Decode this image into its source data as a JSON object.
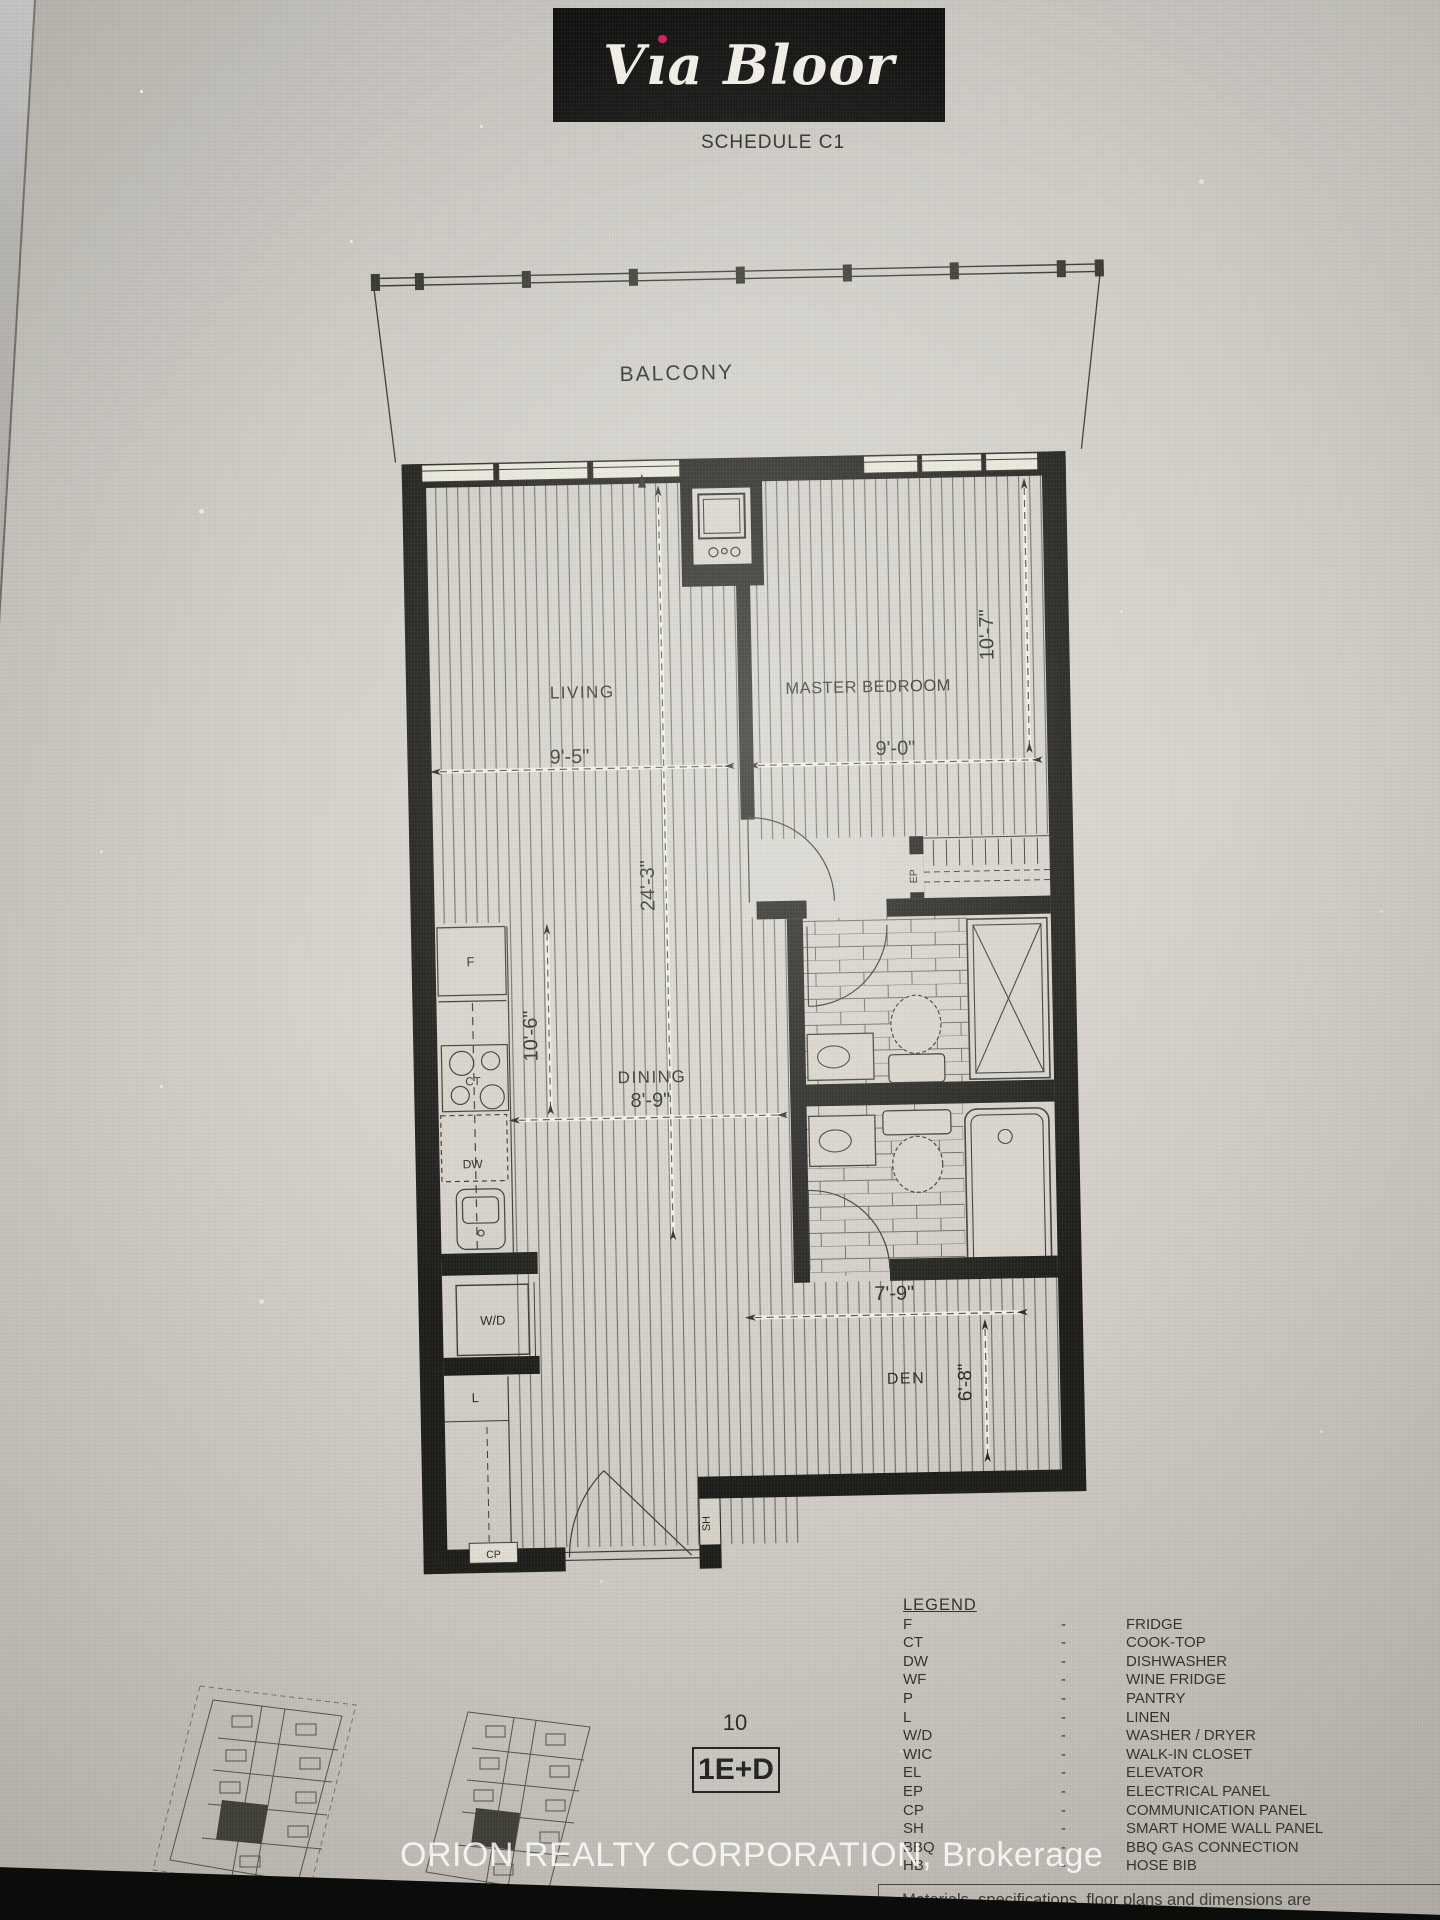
{
  "page": {
    "schedule_label": "SCHEDULE C1"
  },
  "brand": {
    "name_v": "V",
    "name_i": "ı",
    "name_rest": "a Bloor"
  },
  "plan": {
    "rooms": {
      "balcony": "BALCONY",
      "living": "LIVING",
      "master_bedroom": "MASTER BEDROOM",
      "dining": "DINING",
      "den": "DEN"
    },
    "dims": {
      "living_width": "9'-5\"",
      "master_width": "9'-0\"",
      "master_depth": "10'-7\"",
      "overall_depth": "24'-3\"",
      "kitchen_depth": "10'-6\"",
      "dining_width": "8'-9\"",
      "den_width": "7'-9\"",
      "den_depth": "6'-8\""
    },
    "fixtures": {
      "fridge": "F",
      "cooktop": "CT",
      "dishwasher": "DW",
      "washer_dryer": "W/D",
      "linen": "L",
      "electrical_panel": "EP",
      "communication_panel": "CP",
      "smart_home": "SH"
    }
  },
  "unit": {
    "level": "10",
    "model": "1E+D"
  },
  "legend": {
    "title": "LEGEND",
    "separator": "-",
    "rows": [
      {
        "abbr": "F",
        "desc": "FRIDGE"
      },
      {
        "abbr": "CT",
        "desc": "COOK-TOP"
      },
      {
        "abbr": "DW",
        "desc": "DISHWASHER"
      },
      {
        "abbr": "WF",
        "desc": "WINE FRIDGE"
      },
      {
        "abbr": "P",
        "desc": "PANTRY"
      },
      {
        "abbr": "L",
        "desc": "LINEN"
      },
      {
        "abbr": "W/D",
        "desc": "WASHER / DRYER"
      },
      {
        "abbr": "WIC",
        "desc": "WALK-IN CLOSET"
      },
      {
        "abbr": "EL",
        "desc": "ELEVATOR"
      },
      {
        "abbr": "EP",
        "desc": "ELECTRICAL PANEL"
      },
      {
        "abbr": "CP",
        "desc": "COMMUNICATION PANEL"
      },
      {
        "abbr": "SH",
        "desc": "SMART HOME WALL PANEL"
      },
      {
        "abbr": "BBQ",
        "desc": "BBQ GAS CONNECTION"
      },
      {
        "abbr": "HB",
        "desc": "HOSE BIB"
      }
    ]
  },
  "watermark": "ORION REALTY CORPORATION, Brokerage",
  "disclaimer": "Materials, specifications, floor plans and dimensions are",
  "colors": {
    "logo_dot": "#cf1f5e",
    "wall": "#1e1e1a",
    "paper": "#d8d4cc"
  }
}
